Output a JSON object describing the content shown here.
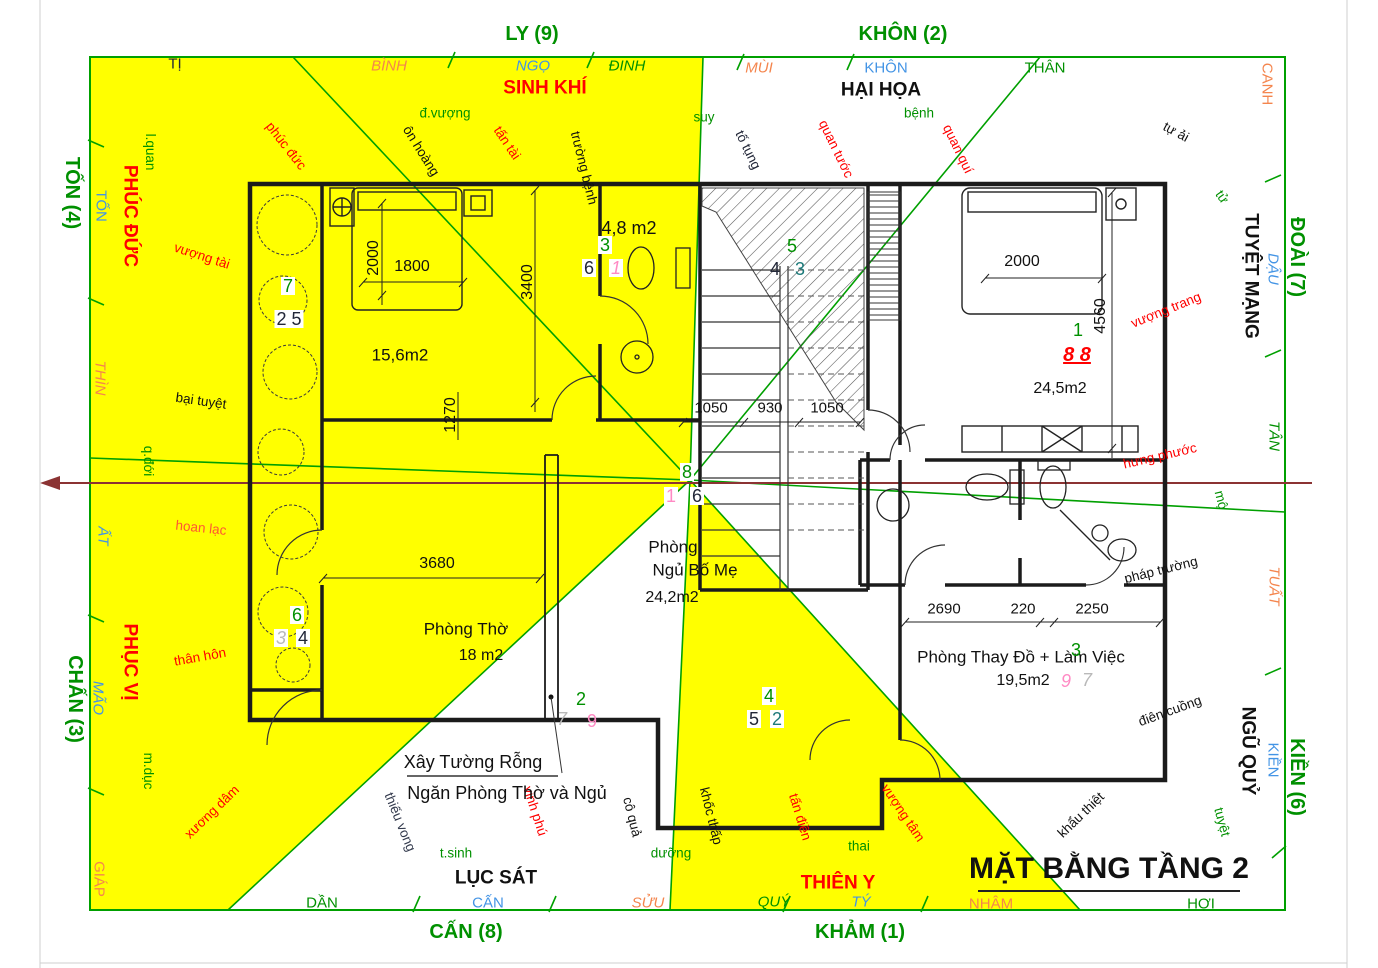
{
  "palette": {
    "green": "#009000",
    "blue": "#4394e5",
    "orange": "#f4854d",
    "red": "#ff0000",
    "black": "#111111",
    "dark": "#222738",
    "pink": "#ff8ac4",
    "grey": "#b9b9b9",
    "teal": "#1d7a7a",
    "maroon": "#8b3333",
    "yellow": "#ffff00",
    "slate": "#333a4d"
  },
  "compass_outer": [
    {
      "n": "compass-ly-9",
      "t": "LY (9)",
      "x": 532,
      "y": 34,
      "c": "green",
      "s": 20,
      "w": 1
    },
    {
      "n": "compass-khon-2",
      "t": "KHÔN (2)",
      "x": 903,
      "y": 34,
      "c": "green",
      "s": 20,
      "w": 1
    },
    {
      "n": "compass-ton-4",
      "t": "TỐN (4)",
      "x": 72,
      "y": 193,
      "r": 90,
      "c": "green",
      "s": 20,
      "w": 1
    },
    {
      "n": "compass-chan-3",
      "t": "CHẤN (3)",
      "x": 75,
      "y": 699,
      "r": 90,
      "c": "green",
      "s": 20,
      "w": 1
    },
    {
      "n": "compass-doai-7",
      "t": "ĐOÀI (7)",
      "x": 1297,
      "y": 257,
      "r": 90,
      "c": "green",
      "s": 20,
      "w": 1
    },
    {
      "n": "compass-kien-6",
      "t": "KIỀN (6)",
      "x": 1297,
      "y": 777,
      "r": 90,
      "c": "green",
      "s": 20,
      "w": 1
    },
    {
      "n": "compass-can-8",
      "t": "CẤN (8)",
      "x": 466,
      "y": 932,
      "c": "green",
      "s": 20,
      "w": 1
    },
    {
      "n": "compass-kham-1",
      "t": "KHẢM (1)",
      "x": 860,
      "y": 932,
      "c": "green",
      "s": 20,
      "w": 1
    }
  ],
  "compass_ring": [
    {
      "n": "ring-ti",
      "t": "TỊ",
      "x": 175,
      "y": 64,
      "c": "dark",
      "s": 15
    },
    {
      "n": "ring-binh",
      "t": "BÌNH",
      "x": 389,
      "y": 66,
      "c": "orange",
      "s": 15,
      "i": 1
    },
    {
      "n": "ring-ngo",
      "t": "NGỌ",
      "x": 533,
      "y": 66,
      "c": "blue",
      "s": 15,
      "i": 1
    },
    {
      "n": "ring-dinh",
      "t": "ĐINH",
      "x": 627,
      "y": 66,
      "c": "green",
      "s": 15,
      "i": 1
    },
    {
      "n": "ring-mui",
      "t": "MÙI",
      "x": 759,
      "y": 68,
      "c": "orange",
      "s": 15,
      "i": 1
    },
    {
      "n": "ring-khon",
      "t": "KHÔN",
      "x": 886,
      "y": 68,
      "c": "blue",
      "s": 15
    },
    {
      "n": "ring-than",
      "t": "THÂN",
      "x": 1045,
      "y": 68,
      "c": "green",
      "s": 15
    },
    {
      "n": "ring-canh",
      "t": "CANH",
      "x": 1267,
      "y": 84,
      "r": 90,
      "c": "orange",
      "s": 15
    },
    {
      "n": "ring-ton",
      "t": "TỐN",
      "x": 101,
      "y": 206,
      "r": 90,
      "c": "blue",
      "s": 15
    },
    {
      "n": "ring-thin",
      "t": "THÌN",
      "x": 100,
      "y": 378,
      "r": 90,
      "c": "orange",
      "s": 15,
      "i": 1
    },
    {
      "n": "ring-at",
      "t": "ẤT",
      "x": 103,
      "y": 536,
      "r": 90,
      "c": "blue",
      "s": 15,
      "i": 1
    },
    {
      "n": "ring-mao",
      "t": "MÃO",
      "x": 98,
      "y": 698,
      "r": 90,
      "c": "blue",
      "s": 15,
      "i": 1
    },
    {
      "n": "ring-giap",
      "t": "GIÁP",
      "x": 99,
      "y": 879,
      "r": 90,
      "c": "orange",
      "s": 15
    },
    {
      "n": "ring-dau",
      "t": "DẬU",
      "x": 1273,
      "y": 269,
      "r": 90,
      "c": "blue",
      "s": 15,
      "i": 1
    },
    {
      "n": "ring-tan",
      "t": "TÂN",
      "x": 1274,
      "y": 436,
      "r": 90,
      "c": "green",
      "s": 15,
      "i": 1
    },
    {
      "n": "ring-tuat",
      "t": "TUẤT",
      "x": 1274,
      "y": 586,
      "r": 90,
      "c": "orange",
      "s": 15,
      "i": 1
    },
    {
      "n": "ring-kien",
      "t": "KIỀN",
      "x": 1273,
      "y": 760,
      "r": 90,
      "c": "blue",
      "s": 15
    },
    {
      "n": "ring-dan",
      "t": "DẦN",
      "x": 322,
      "y": 903,
      "c": "green",
      "s": 15
    },
    {
      "n": "ring-can",
      "t": "CẤN",
      "x": 488,
      "y": 903,
      "c": "blue",
      "s": 15
    },
    {
      "n": "ring-suu",
      "t": "SỬU",
      "x": 648,
      "y": 903,
      "c": "orange",
      "s": 15,
      "i": 1
    },
    {
      "n": "ring-quy",
      "t": "QUÝ",
      "x": 774,
      "y": 902,
      "c": "green",
      "s": 15,
      "i": 1
    },
    {
      "n": "ring-ty",
      "t": "TÝ",
      "x": 861,
      "y": 902,
      "c": "blue",
      "s": 15,
      "i": 1
    },
    {
      "n": "ring-nham",
      "t": "NHÂM",
      "x": 991,
      "y": 904,
      "c": "orange",
      "s": 15
    },
    {
      "n": "ring-hoi",
      "t": "HỢI",
      "x": 1201,
      "y": 904,
      "c": "green",
      "s": 15
    }
  ],
  "zones": [
    {
      "n": "zone-sinh-khi",
      "t": "SINH KHÍ",
      "x": 545,
      "y": 88,
      "c": "red",
      "s": 19,
      "w": 1
    },
    {
      "n": "zone-hai-hoa",
      "t": "HẠI HỌA",
      "x": 881,
      "y": 90,
      "c": "black",
      "s": 19,
      "w": 1
    },
    {
      "n": "zone-phuc-duc",
      "t": "PHÚC ĐỨC",
      "x": 130,
      "y": 216,
      "r": 90,
      "c": "red",
      "s": 19,
      "w": 1
    },
    {
      "n": "zone-phuc-vi",
      "t": "PHỤC VỊ",
      "x": 130,
      "y": 662,
      "r": 90,
      "c": "red",
      "s": 19,
      "w": 1
    },
    {
      "n": "zone-tuyet-mang",
      "t": "TUYỆT MẠNG",
      "x": 1251,
      "y": 276,
      "r": 90,
      "c": "black",
      "s": 19,
      "w": 1
    },
    {
      "n": "zone-ngu-quy",
      "t": "NGŨ QUỶ",
      "x": 1248,
      "y": 751,
      "r": 90,
      "c": "black",
      "s": 19,
      "w": 1
    },
    {
      "n": "zone-luc-sat",
      "t": "LỤC SÁT",
      "x": 496,
      "y": 878,
      "c": "black",
      "s": 19,
      "w": 1
    },
    {
      "n": "zone-thien-y",
      "t": "THIÊN Y",
      "x": 838,
      "y": 883,
      "c": "red",
      "s": 19,
      "w": 1
    }
  ],
  "energy": [
    {
      "n": "energy-d-vuong",
      "t": "đ.vượng",
      "x": 445,
      "y": 113,
      "c": "green",
      "s": 13.5
    },
    {
      "n": "energy-suy",
      "t": "suy",
      "x": 704,
      "y": 117,
      "c": "green",
      "s": 13.5
    },
    {
      "n": "energy-benh",
      "t": "bệnh",
      "x": 919,
      "y": 113,
      "c": "green",
      "s": 13.5
    },
    {
      "n": "energy-t-sinh",
      "t": "t.sinh",
      "x": 456,
      "y": 853,
      "c": "green",
      "s": 13.5
    },
    {
      "n": "energy-duong",
      "t": "dưỡng",
      "x": 671,
      "y": 853,
      "c": "green",
      "s": 13.5
    },
    {
      "n": "energy-thai",
      "t": "thai",
      "x": 859,
      "y": 846,
      "c": "green",
      "s": 13.5
    },
    {
      "n": "energy-l-quan",
      "t": "l.quan",
      "x": 150,
      "y": 152,
      "r": 90,
      "c": "green",
      "s": 13.5
    },
    {
      "n": "energy-q-doi",
      "t": "q.đới",
      "x": 148,
      "y": 461,
      "r": 90,
      "c": "green",
      "s": 13.5
    },
    {
      "n": "energy-m-duc",
      "t": "m.dục",
      "x": 148,
      "y": 771,
      "r": 90,
      "c": "green",
      "s": 13.5
    },
    {
      "n": "energy-tu",
      "t": "tử",
      "x": 1222,
      "y": 197,
      "r": 55,
      "c": "green",
      "s": 13.5
    },
    {
      "n": "energy-mo",
      "t": "mộ",
      "x": 1221,
      "y": 500,
      "r": 75,
      "c": "green",
      "s": 13.5
    },
    {
      "n": "energy-tuyet",
      "t": "tuyệt",
      "x": 1222,
      "y": 822,
      "r": 75,
      "c": "green",
      "s": 13.5
    },
    {
      "n": "energy-phuc-duc",
      "t": "phúc đức",
      "x": 286,
      "y": 146,
      "r": 52,
      "c": "red",
      "s": 13.5
    },
    {
      "n": "energy-on-hoang",
      "t": "ôn hoàng",
      "x": 421,
      "y": 151,
      "r": 58,
      "c": "black",
      "s": 13.5
    },
    {
      "n": "energy-tan-tai",
      "t": "tấn tài",
      "x": 507,
      "y": 143,
      "r": 56,
      "c": "red",
      "s": 13.5
    },
    {
      "n": "energy-truong-benh",
      "t": "trường bệnh",
      "x": 584,
      "y": 168,
      "r": 76,
      "c": "black",
      "s": 13.5
    },
    {
      "n": "energy-to-tung",
      "t": "tố tụng",
      "x": 748,
      "y": 150,
      "r": 64,
      "c": "dark",
      "s": 13.5
    },
    {
      "n": "energy-quan-tuoc",
      "t": "quan tước",
      "x": 836,
      "y": 149,
      "r": 64,
      "c": "red",
      "s": 13.5
    },
    {
      "n": "energy-quan-qui",
      "t": "quan quí",
      "x": 958,
      "y": 149,
      "r": 64,
      "c": "red",
      "s": 13.5
    },
    {
      "n": "energy-tu-ai",
      "t": "tự ải",
      "x": 1176,
      "y": 132,
      "r": 28,
      "c": "black",
      "s": 13.5
    },
    {
      "n": "energy-vuong-tai",
      "t": "vượng tài",
      "x": 202,
      "y": 256,
      "r": 18,
      "c": "red",
      "s": 13.5
    },
    {
      "n": "energy-bai-tuyet",
      "t": "bại tuyệt",
      "x": 201,
      "y": 401,
      "r": 8,
      "c": "black",
      "s": 13.5
    },
    {
      "n": "energy-hoan-lac",
      "t": "hoan lạc",
      "x": 201,
      "y": 528,
      "r": 6,
      "c": "#ff5533",
      "s": 13.5
    },
    {
      "n": "energy-than-hon",
      "t": "thân hôn",
      "x": 200,
      "y": 657,
      "r": -10,
      "c": "red",
      "s": 13.5
    },
    {
      "n": "energy-xuong-dam",
      "t": "xương dâm",
      "x": 212,
      "y": 812,
      "r": -44,
      "c": "red",
      "s": 13.5
    },
    {
      "n": "energy-vuong-trang",
      "t": "vượng trang",
      "x": 1166,
      "y": 310,
      "r": -22,
      "c": "red",
      "s": 13.5
    },
    {
      "n": "energy-hung-phuoc",
      "t": "hưng phước",
      "x": 1160,
      "y": 456,
      "r": -13,
      "c": "red",
      "s": 13.5
    },
    {
      "n": "energy-phap-truong",
      "t": "pháp trường",
      "x": 1161,
      "y": 570,
      "r": -14,
      "c": "black",
      "s": 13.5
    },
    {
      "n": "energy-dien-cuong",
      "t": "điên cuồng",
      "x": 1170,
      "y": 711,
      "r": -20,
      "c": "black",
      "s": 13.5
    },
    {
      "n": "energy-khau-thiet",
      "t": "khẩu thiệt",
      "x": 1081,
      "y": 815,
      "r": -44,
      "c": "black",
      "s": 13.5
    },
    {
      "n": "energy-thieu-vong",
      "t": "thiếu vong",
      "x": 400,
      "y": 822,
      "r": 68,
      "c": "slate",
      "s": 13.5
    },
    {
      "n": "energy-vinh-phu",
      "t": "vinh phú",
      "x": 535,
      "y": 811,
      "r": 72,
      "c": "red",
      "s": 13.5
    },
    {
      "n": "energy-co-qua",
      "t": "cô quả",
      "x": 632,
      "y": 817,
      "r": 76,
      "c": "black",
      "s": 13.5
    },
    {
      "n": "energy-khoc-thap",
      "t": "khốc thấp",
      "x": 711,
      "y": 816,
      "r": 76,
      "c": "black",
      "s": 13.5
    },
    {
      "n": "energy-tan-dien",
      "t": "tấn điền",
      "x": 800,
      "y": 817,
      "r": 73,
      "c": "red",
      "s": 13.5
    },
    {
      "n": "energy-vuong-tam",
      "t": "vượng tâm",
      "x": 903,
      "y": 813,
      "r": 56,
      "c": "red",
      "s": 13.5
    }
  ],
  "rooms": [
    {
      "n": "room-ngu-bo-me-line1",
      "t": "Phòng",
      "x": 673,
      "y": 547,
      "c": "black",
      "s": 17
    },
    {
      "n": "room-ngu-bo-me-line2",
      "t": "Ngủ Bố Mẹ",
      "x": 695,
      "y": 570,
      "c": "black",
      "s": 17
    },
    {
      "n": "room-ngu-bo-me-area",
      "t": "24,2m2",
      "x": 672,
      "y": 598,
      "c": "black",
      "s": 16
    },
    {
      "n": "room-phong-tho",
      "t": "Phòng Thờ",
      "x": 466,
      "y": 629,
      "c": "black",
      "s": 17
    },
    {
      "n": "room-phong-tho-area",
      "t": "18 m2",
      "x": 481,
      "y": 656,
      "c": "black",
      "s": 16
    },
    {
      "n": "room-thay-do",
      "t": "Phòng Thay Đồ + Làm Việc",
      "x": 1021,
      "y": 657,
      "c": "black",
      "s": 17
    },
    {
      "n": "room-thay-do-area",
      "t": "19,5m2",
      "x": 1023,
      "y": 681,
      "c": "black",
      "s": 16
    },
    {
      "n": "room-ngu-lon-area",
      "t": "24,5m2",
      "x": 1060,
      "y": 389,
      "c": "black",
      "s": 16
    },
    {
      "n": "room-wc-area",
      "t": "4,8 m2",
      "x": 629,
      "y": 228,
      "c": "black",
      "s": 18
    },
    {
      "n": "room-ngu-nho-area",
      "t": "15,6m2",
      "x": 400,
      "y": 355,
      "c": "black",
      "s": 17
    }
  ],
  "numbers": [
    {
      "n": "star-7-nw",
      "t": "7",
      "x": 288,
      "y": 286,
      "c": "green",
      "s": 18,
      "bg": 1
    },
    {
      "n": "star-2-5-nw",
      "t": "2 5",
      "x": 289,
      "y": 319,
      "c": "dark",
      "s": 18,
      "bg": 1
    },
    {
      "n": "star-3-wc",
      "t": "3",
      "x": 605,
      "y": 245,
      "c": "green",
      "s": 18,
      "bg": 1
    },
    {
      "n": "star-6-wc",
      "t": "6",
      "x": 589,
      "y": 268,
      "c": "dark",
      "s": 18,
      "bg": 1
    },
    {
      "n": "star-1-wc",
      "t": "1",
      "x": 616,
      "y": 268,
      "c": "pink",
      "s": 18,
      "i": 1,
      "bg": 1
    },
    {
      "n": "star-5-stairs",
      "t": "5",
      "x": 792,
      "y": 246,
      "c": "green",
      "s": 18
    },
    {
      "n": "star-4-stairs",
      "t": "4",
      "x": 775,
      "y": 269,
      "c": "dark",
      "s": 18
    },
    {
      "n": "star-3-stairs",
      "t": "3",
      "x": 800,
      "y": 269,
      "c": "teal",
      "s": 18
    },
    {
      "n": "star-1-ne",
      "t": "1",
      "x": 1078,
      "y": 330,
      "c": "green",
      "s": 18
    },
    {
      "n": "star-8-8-ne",
      "t": "8 8",
      "x": 1077,
      "y": 355,
      "c": "red",
      "s": 20,
      "w": 1,
      "i": 1,
      "u": 1
    },
    {
      "n": "star-8-center",
      "t": "8",
      "x": 687,
      "y": 472,
      "c": "green",
      "s": 18,
      "bg": 1
    },
    {
      "n": "star-1-center",
      "t": "1",
      "x": 671,
      "y": 496,
      "c": "pink",
      "s": 18,
      "bg": 1
    },
    {
      "n": "star-6-center",
      "t": "6",
      "x": 697,
      "y": 496,
      "c": "dark",
      "s": 18,
      "bg": 1
    },
    {
      "n": "star-6-w",
      "t": "6",
      "x": 297,
      "y": 615,
      "c": "green",
      "s": 18,
      "bg": 1
    },
    {
      "n": "star-3-w",
      "t": "3",
      "x": 281,
      "y": 638,
      "c": "grey",
      "s": 18,
      "i": 1,
      "bg": 1
    },
    {
      "n": "star-4-w",
      "t": "4",
      "x": 303,
      "y": 638,
      "c": "dark",
      "s": 18,
      "bg": 1
    },
    {
      "n": "star-2-s",
      "t": "2",
      "x": 581,
      "y": 699,
      "c": "green",
      "s": 18
    },
    {
      "n": "star-7-s",
      "t": "7",
      "x": 562,
      "y": 719,
      "c": "grey",
      "s": 18,
      "i": 1
    },
    {
      "n": "star-9-s",
      "t": "9",
      "x": 592,
      "y": 721,
      "c": "pink",
      "s": 18
    },
    {
      "n": "star-4-door",
      "t": "4",
      "x": 769,
      "y": 696,
      "c": "green",
      "s": 18,
      "bg": 1
    },
    {
      "n": "star-5-door",
      "t": "5",
      "x": 754,
      "y": 719,
      "c": "dark",
      "s": 18,
      "bg": 1
    },
    {
      "n": "star-2-door",
      "t": "2",
      "x": 777,
      "y": 719,
      "c": "teal",
      "s": 18,
      "bg": 1
    },
    {
      "n": "star-3-se",
      "t": "3",
      "x": 1076,
      "y": 650,
      "c": "green",
      "s": 18
    },
    {
      "n": "star-9-se",
      "t": "9",
      "x": 1066,
      "y": 681,
      "c": "pink",
      "s": 18,
      "i": 1
    },
    {
      "n": "star-7-se",
      "t": "7",
      "x": 1087,
      "y": 680,
      "c": "grey",
      "s": 18,
      "i": 1
    }
  ],
  "dimensions": [
    {
      "n": "dim-2000-left",
      "t": "2000",
      "x": 374,
      "y": 258,
      "r": -90,
      "c": "black",
      "s": 16
    },
    {
      "n": "dim-1800",
      "t": "1800",
      "x": 412,
      "y": 267,
      "c": "black",
      "s": 16
    },
    {
      "n": "dim-3400",
      "t": "3400",
      "x": 528,
      "y": 282,
      "r": -90,
      "c": "black",
      "s": 16
    },
    {
      "n": "dim-1270",
      "t": "1270",
      "x": 451,
      "y": 415,
      "r": -90,
      "c": "black",
      "s": 16
    },
    {
      "n": "dim-1050-a",
      "t": "1050",
      "x": 711,
      "y": 408,
      "c": "black",
      "s": 15
    },
    {
      "n": "dim-930",
      "t": "930",
      "x": 770,
      "y": 408,
      "c": "black",
      "s": 15
    },
    {
      "n": "dim-1050-b",
      "t": "1050",
      "x": 827,
      "y": 408,
      "c": "black",
      "s": 15
    },
    {
      "n": "dim-2000-right",
      "t": "2000",
      "x": 1022,
      "y": 262,
      "c": "black",
      "s": 16
    },
    {
      "n": "dim-4560",
      "t": "4560",
      "x": 1101,
      "y": 316,
      "r": -90,
      "c": "black",
      "s": 16
    },
    {
      "n": "dim-2690",
      "t": "2690",
      "x": 944,
      "y": 609,
      "c": "black",
      "s": 15
    },
    {
      "n": "dim-220",
      "t": "220",
      "x": 1023,
      "y": 609,
      "c": "black",
      "s": 15
    },
    {
      "n": "dim-2250",
      "t": "2250",
      "x": 1092,
      "y": 609,
      "c": "black",
      "s": 15
    },
    {
      "n": "dim-3680",
      "t": "3680",
      "x": 437,
      "y": 564,
      "c": "black",
      "s": 16
    }
  ],
  "misc": [
    {
      "n": "page-title",
      "t": "MẶT BẰNG TẦNG 2",
      "x": 1109,
      "y": 869,
      "c": "black",
      "s": 30,
      "w": 1
    },
    {
      "n": "annotation-line1",
      "t": "Xây Tường Rỗng",
      "x": 473,
      "y": 762,
      "c": "black",
      "s": 18
    },
    {
      "n": "annotation-line2",
      "t": "Ngăn Phòng Thờ và Ngủ",
      "x": 507,
      "y": 793,
      "c": "black",
      "s": 18
    }
  ]
}
